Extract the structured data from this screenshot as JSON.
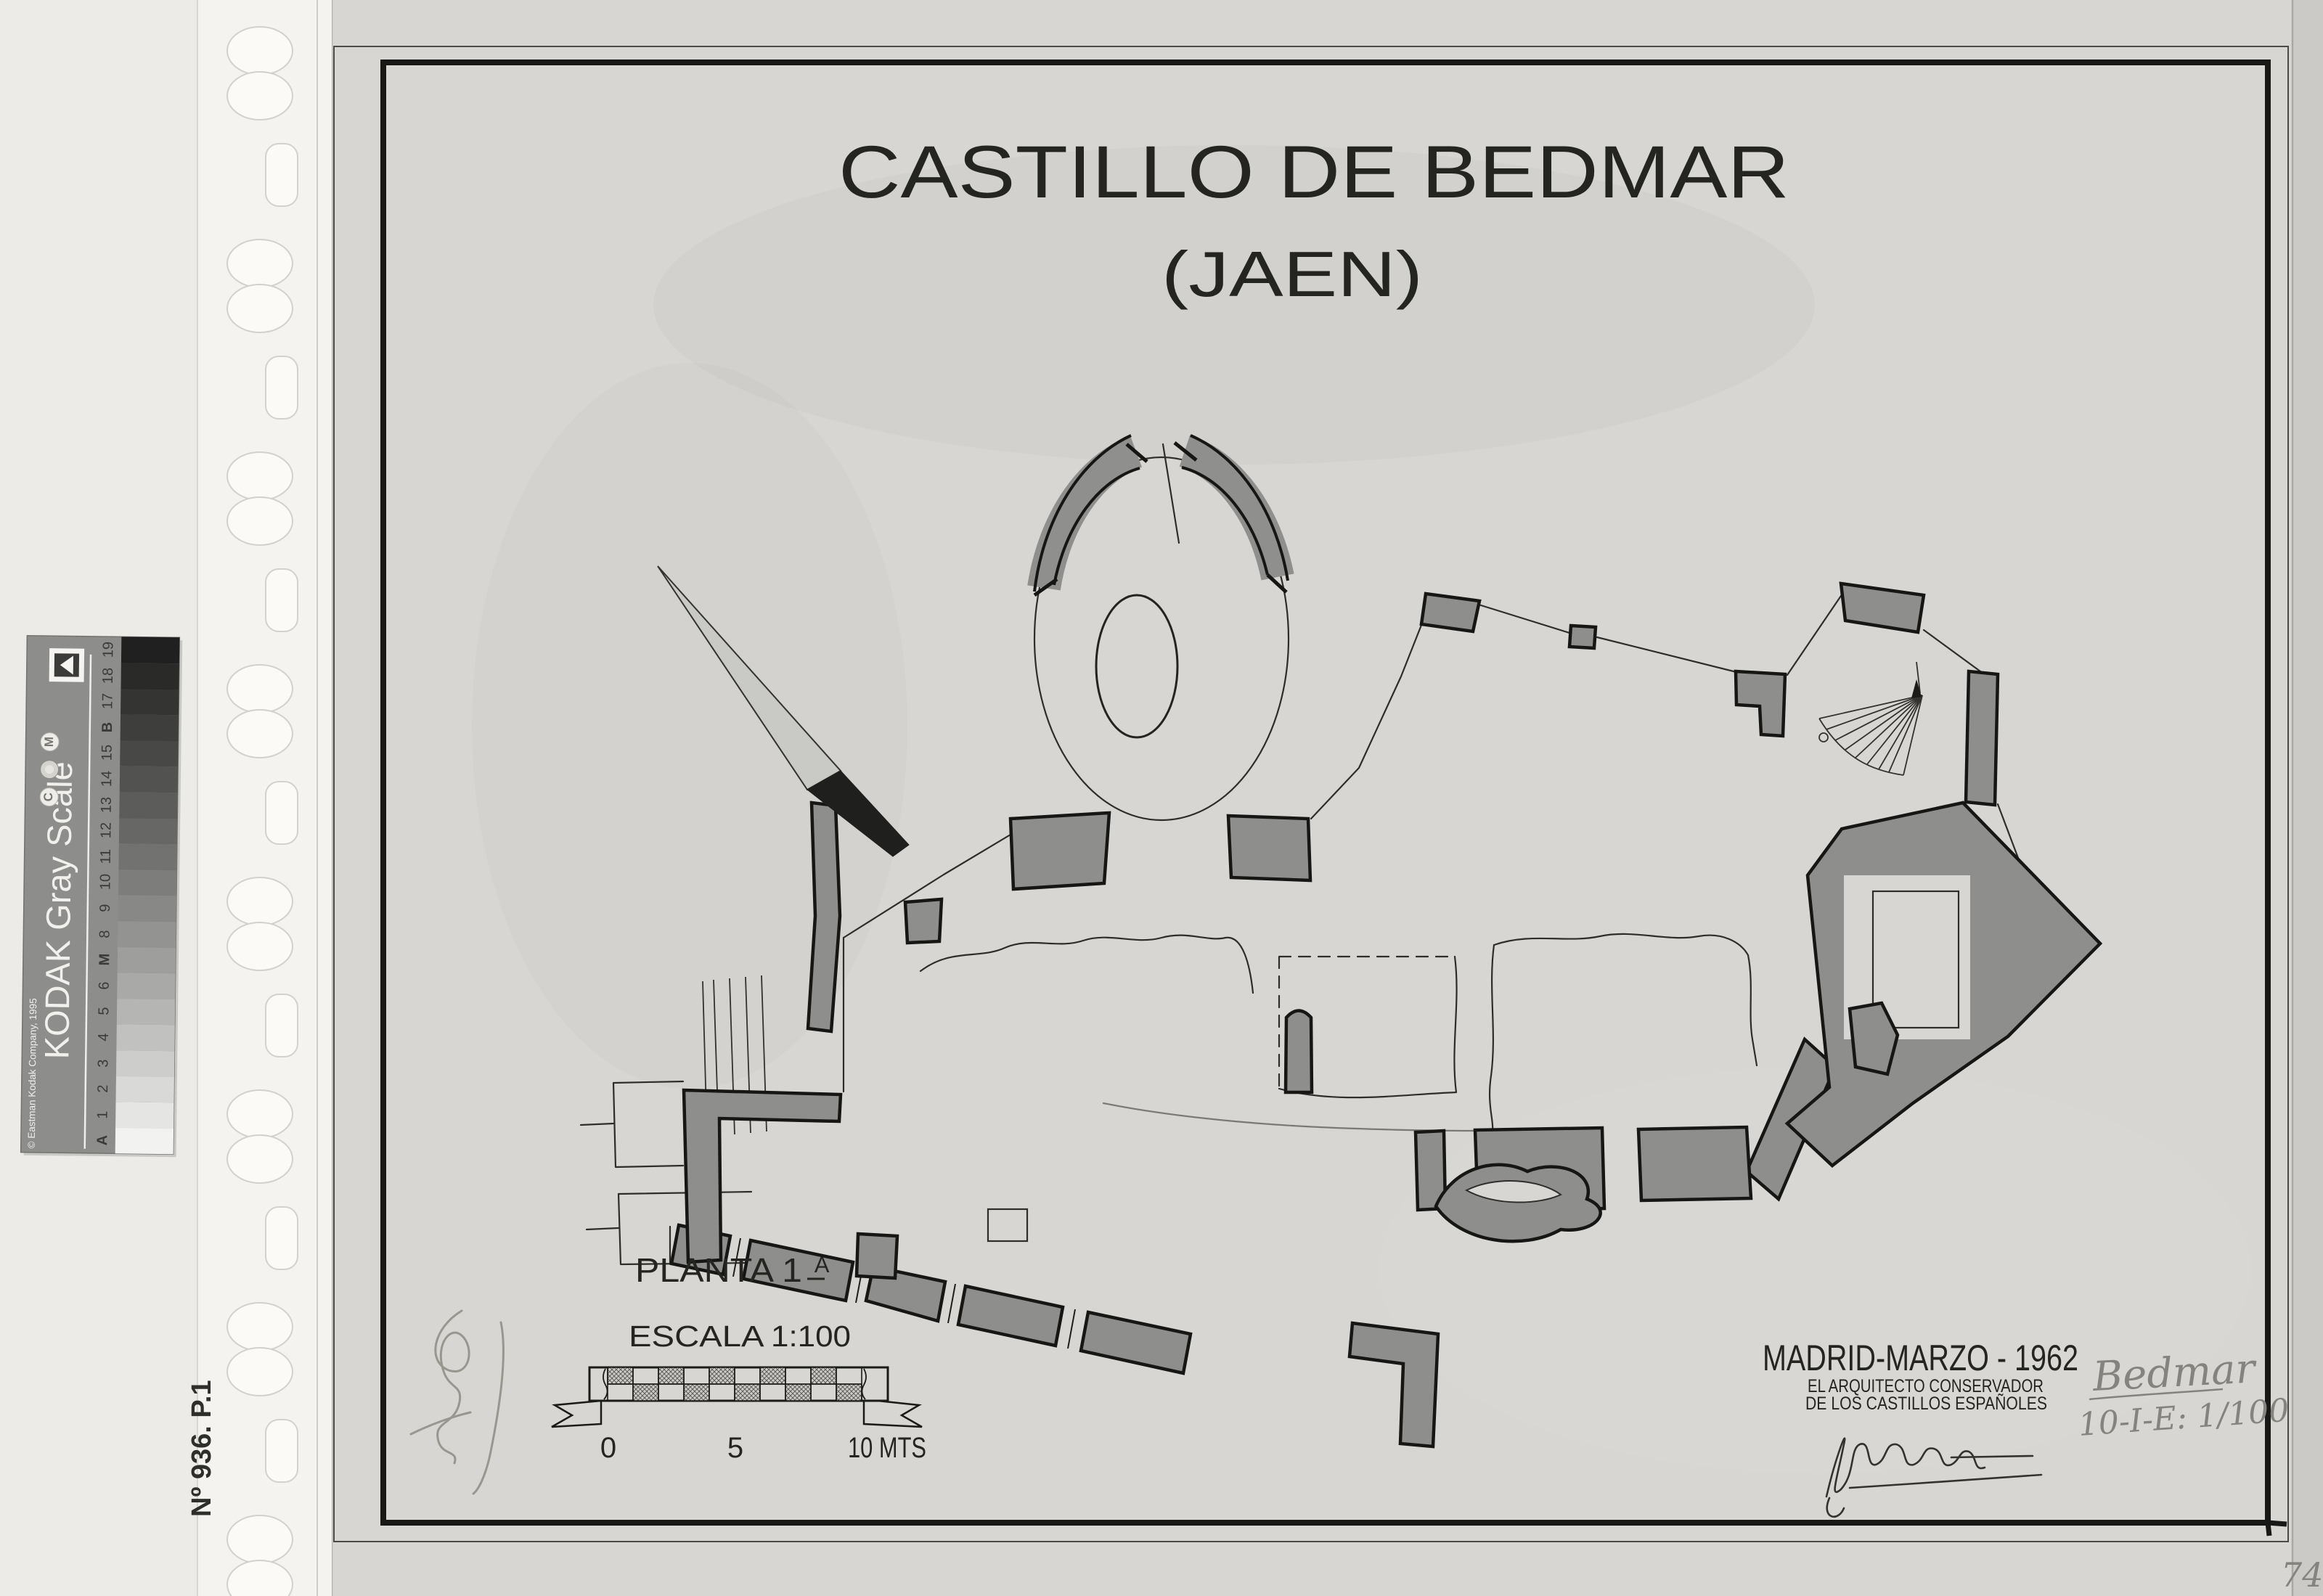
{
  "page": {
    "title": "CASTILLO DE BEDMAR",
    "subtitle": "(JAEN)",
    "plan_label": "PLANTA 1",
    "plan_label_sup": "A",
    "scale_word": "ESCALA",
    "scale_ratio": "1:100",
    "scale_tick_0": "0",
    "scale_tick_5": "5",
    "scale_tick_10": "10 MTS",
    "place_date": "MADRID-MARZO - 1962",
    "credit_line_1": "EL ARQUITECTO CONSERVADOR",
    "credit_line_2": "DE LOS CASTILLOS ESPAÑOLES",
    "page_number": "74"
  },
  "annotations": {
    "archive_number": "Nº 936. P.1",
    "pencil_name": "Bedmar",
    "pencil_ref": "10-I-E: 1/100"
  },
  "kodak_strip": {
    "brand": "KODAK Gray Scale",
    "copyright": "© Eastman Kodak Company, 1995",
    "circle_c": "C",
    "circle_m": "M",
    "labels": [
      "A",
      "1",
      "2",
      "3",
      "4",
      "5",
      "6",
      "M",
      "8",
      "9",
      "10",
      "11",
      "12",
      "13",
      "14",
      "15",
      "B",
      "17",
      "18",
      "19"
    ],
    "patch_colors": [
      "#f2f2f0",
      "#e5e5e3",
      "#d9d9d7",
      "#cdcdcb",
      "#c1c1bf",
      "#b5b5b3",
      "#a9a9a7",
      "#9e9e9c",
      "#939391",
      "#888886",
      "#7d7d7b",
      "#727270",
      "#676765",
      "#5c5c5a",
      "#525250",
      "#484846",
      "#3e3e3c",
      "#343432",
      "#2a2a28",
      "#202020"
    ]
  },
  "colors": {
    "sheet": "#d7d6d2",
    "margin": "#ecebe7",
    "filing_strip": "#f4f3ef",
    "wall_fill": "#8e8e8c",
    "ink": "#1b1b19",
    "pencil": "#85847f"
  }
}
